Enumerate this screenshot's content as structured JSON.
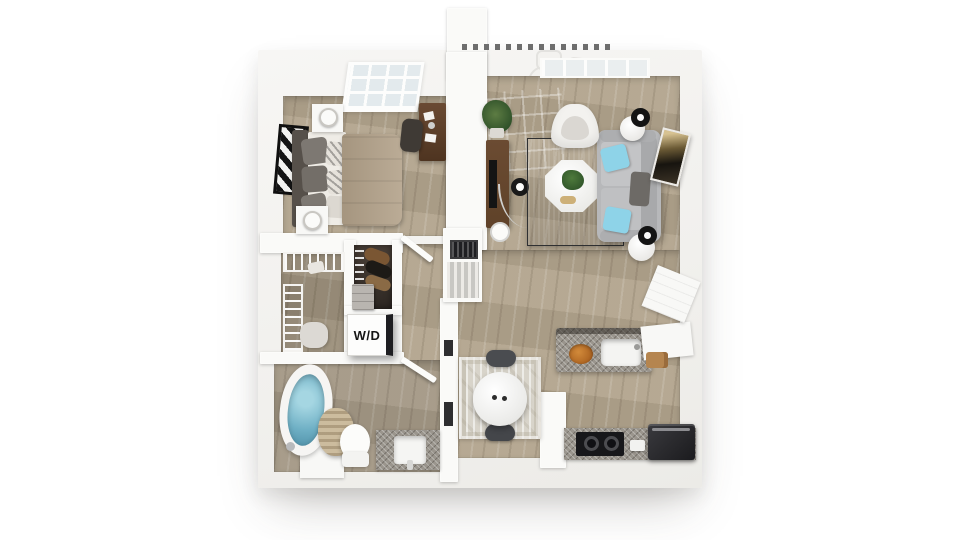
{
  "title": "One-bedroom apartment 3D floor plan render",
  "labels": {
    "washer_dryer": "W/D"
  },
  "palette": {
    "bg": "#ffffff",
    "wall": "#f2f1ee",
    "wall-bright": "#fafaf8",
    "wood": "#b2a48d",
    "granite": "#9a958d",
    "rug-dark": "#434448",
    "sofa": "#b7b8ba",
    "pillow-blue": "#8ed3e8",
    "blanket": "#b3a28a",
    "headboard": "#56504a",
    "water": "#6fb0c5",
    "console-brown": "#5f4229",
    "desk-brown": "#6a4a33",
    "basket": "#ccbc9e",
    "chair-dark": "#4a4c50",
    "dining-rug": "#d8d4ca",
    "appliance": "#1b1b1e",
    "art-gold": "#c9a96a",
    "closet-dark": "#2e2823"
  },
  "rooms": {
    "bedroom": {
      "furniture": [
        "bed",
        "headboard",
        "pillows",
        "blanket",
        "nightstand-north",
        "nightstand-south",
        "table-lamps",
        "desk",
        "desk-chair",
        "skylight-window",
        "wall-art"
      ]
    },
    "living_room": {
      "furniture": [
        "sofa",
        "blue-accent-pillows",
        "area-rug",
        "octagon-coffee-table",
        "tv-console",
        "tv",
        "arc-floor-lamp",
        "side-tables",
        "black-lamps",
        "accent-arch-chair",
        "potted-plant",
        "wall-art"
      ]
    },
    "balcony": {
      "furniture": [
        "railing",
        "patio-table",
        "patio-chairs"
      ]
    },
    "closets": {
      "furniture": [
        "wire-shelving",
        "hanging-clothes",
        "dresser",
        "washer-dryer"
      ]
    },
    "bathroom": {
      "furniture": [
        "soaking-tub",
        "wicker-basket",
        "toilet",
        "vanity-with-sink",
        "door"
      ]
    },
    "dining": {
      "furniture": [
        "round-marble-table",
        "two-dark-chairs",
        "patterned-rug"
      ]
    },
    "kitchen": {
      "furniture": [
        "island-with-sink",
        "fruit-bowl",
        "corner-cabinet",
        "counter",
        "cooktop",
        "refrigerator"
      ]
    }
  }
}
